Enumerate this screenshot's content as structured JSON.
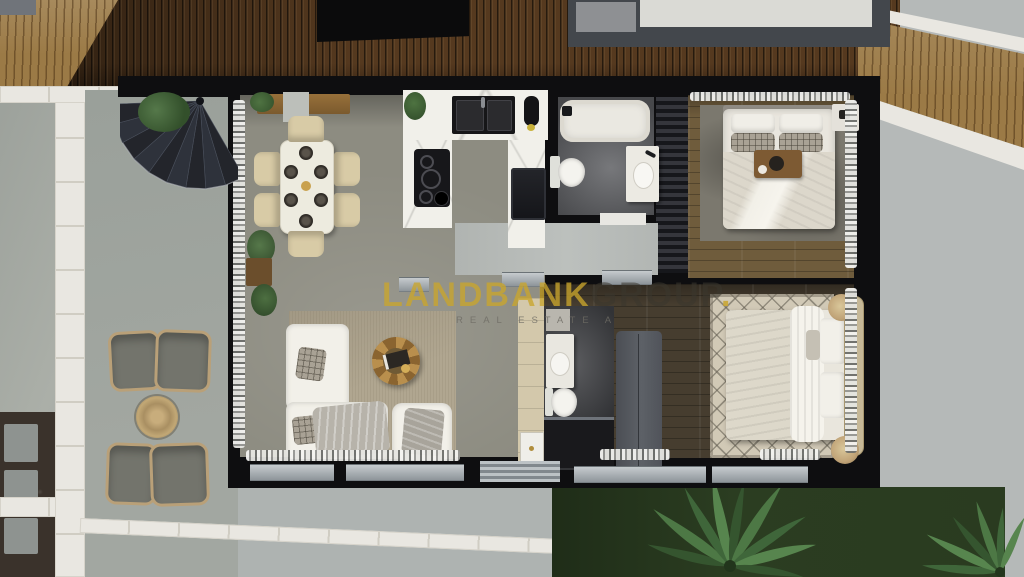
{
  "watermark": {
    "brand": "LANDBANK",
    "brand_suffix": "GROUP",
    "brand_dot": ".",
    "tagline": "REAL ESTATE A",
    "brand_color": "#C9A52D",
    "suffix_color": "#3A362E",
    "tagline_color": "#6E6C64"
  },
  "palette": {
    "deck_wood_dark": "#55391F",
    "deck_wood_light": "#9B7A46",
    "outdoor_concrete": "#A6ABA4",
    "marble_path": "#E9E7E1",
    "interior_floor": "#8D8C81",
    "bedroom1_wood": "#6F5C3C",
    "bedroom2_wood": "#463D2F",
    "wall_black": "#0E0E10",
    "grass_green": "#283920",
    "counter_marble": "#F1F0EA",
    "sofa_white": "#F2F0E9"
  },
  "scene": {
    "type": "3d-floor-plan-top-view-render",
    "areas": [
      "wooden-deck-top",
      "side-concrete-paths",
      "entry-terrace-with-spiral-staircase",
      "dining-area",
      "kitchen",
      "bathroom-1",
      "bedroom-1",
      "hallway",
      "living-room",
      "bathroom-2",
      "bedroom-2",
      "outdoor-lounge-terrace",
      "garden-lawn-with-palms"
    ],
    "furniture": {
      "dining": [
        "wood-console",
        "dining-table",
        "6-chairs",
        "6-place-settings"
      ],
      "kitchen": [
        "u-shaped-marble-counter",
        "double-sink",
        "cooktop",
        "built-in-appliance"
      ],
      "bathroom_1": [
        "bathtub",
        "toilet",
        "vanity-basin"
      ],
      "bedroom_1": [
        "double-bed",
        "plaid-pillows",
        "breakfast-tray",
        "area-rug",
        "nightstand"
      ],
      "living": [
        "l-shaped-sofa",
        "round-coffee-table",
        "armchair",
        "area-rug",
        "plants"
      ],
      "bathroom_2": [
        "vanity-basin",
        "toilet",
        "walk-in-shower",
        "tall-cabinet"
      ],
      "bedroom_2": [
        "double-bed",
        "upholstered-headboard",
        "trellis-rug",
        "two-poufs",
        "wardrobe"
      ],
      "terrace": [
        "4-lounge-chairs",
        "round-woven-mat"
      ],
      "garden": [
        "lawn",
        "2-palm-trees",
        "garden-bed-with-pavers"
      ]
    }
  }
}
